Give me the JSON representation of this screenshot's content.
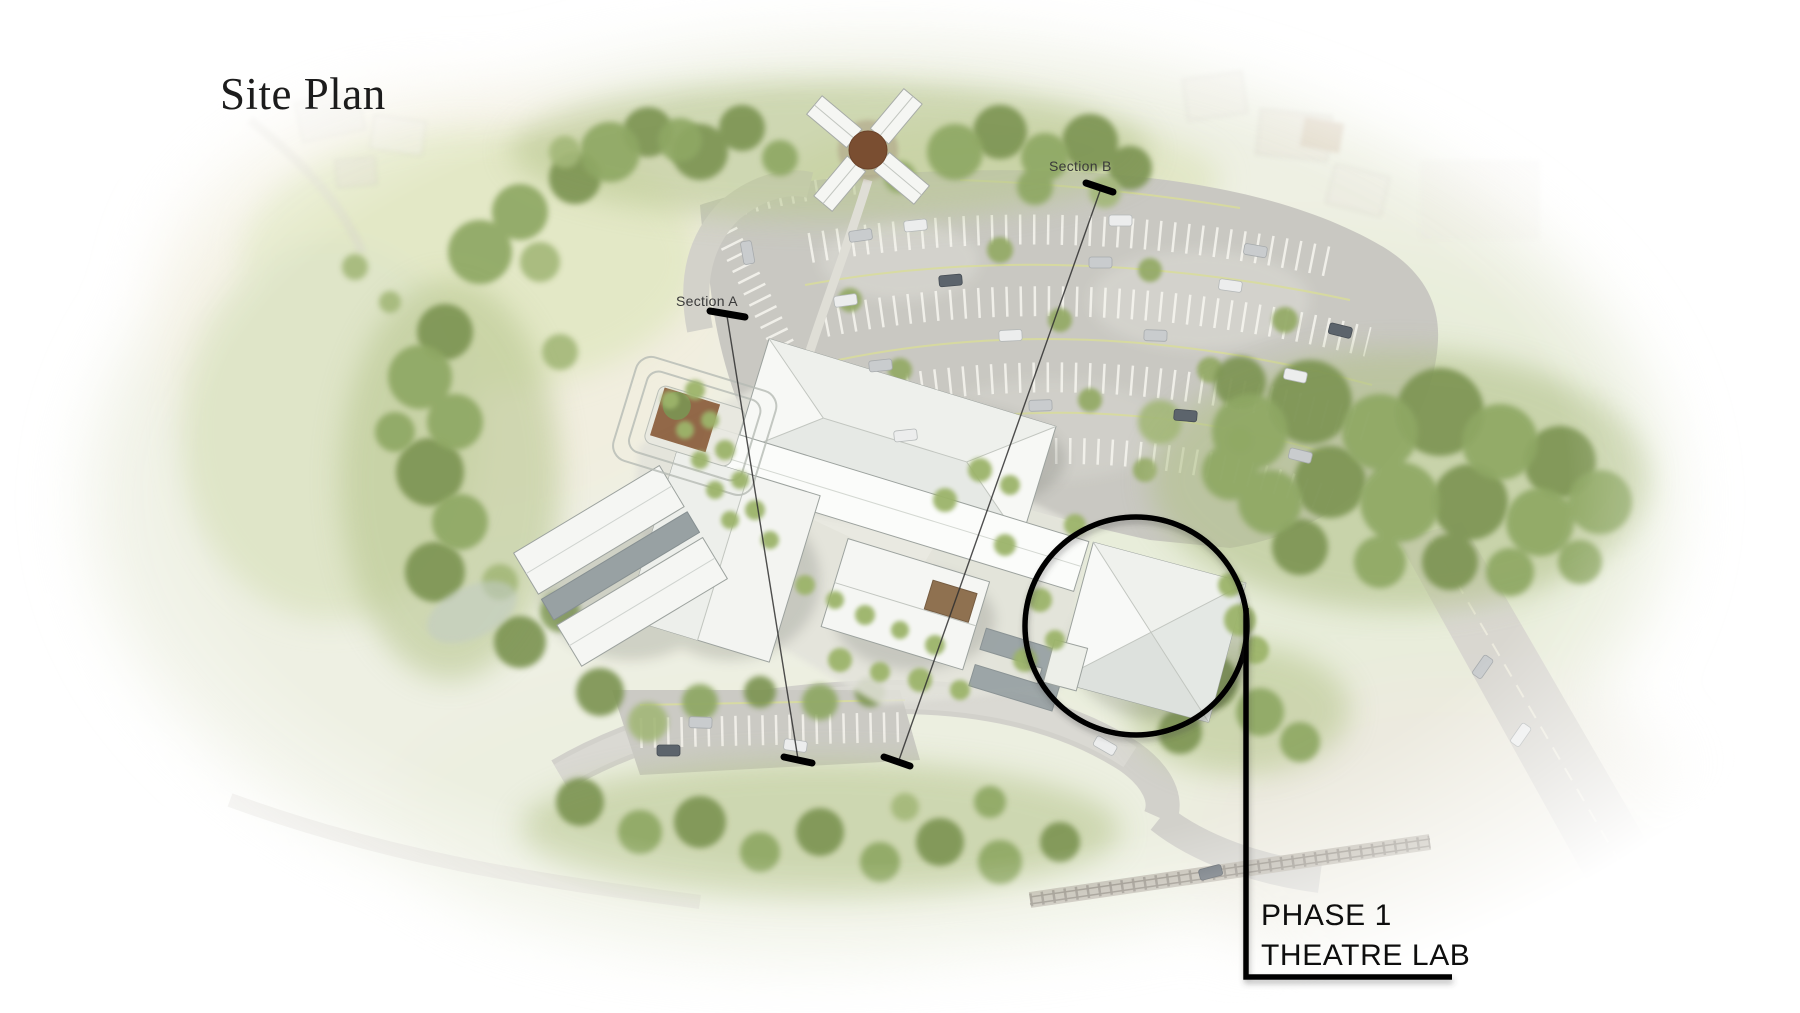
{
  "title": "Site Plan",
  "sections": {
    "a_label": "Section A",
    "b_label": "Section B"
  },
  "callout": {
    "phase": "PHASE 1",
    "name": "THEATRE LAB"
  },
  "colors": {
    "annotation_ink": "#000000",
    "title_ink": "#1c1c1c",
    "canopy_green": "#7d9452",
    "lawn_green": "#dfe5c4",
    "asphalt_gray": "#c9c8c2",
    "building_white": "#f7f8f5",
    "stage_brown": "#8a5c3b"
  }
}
